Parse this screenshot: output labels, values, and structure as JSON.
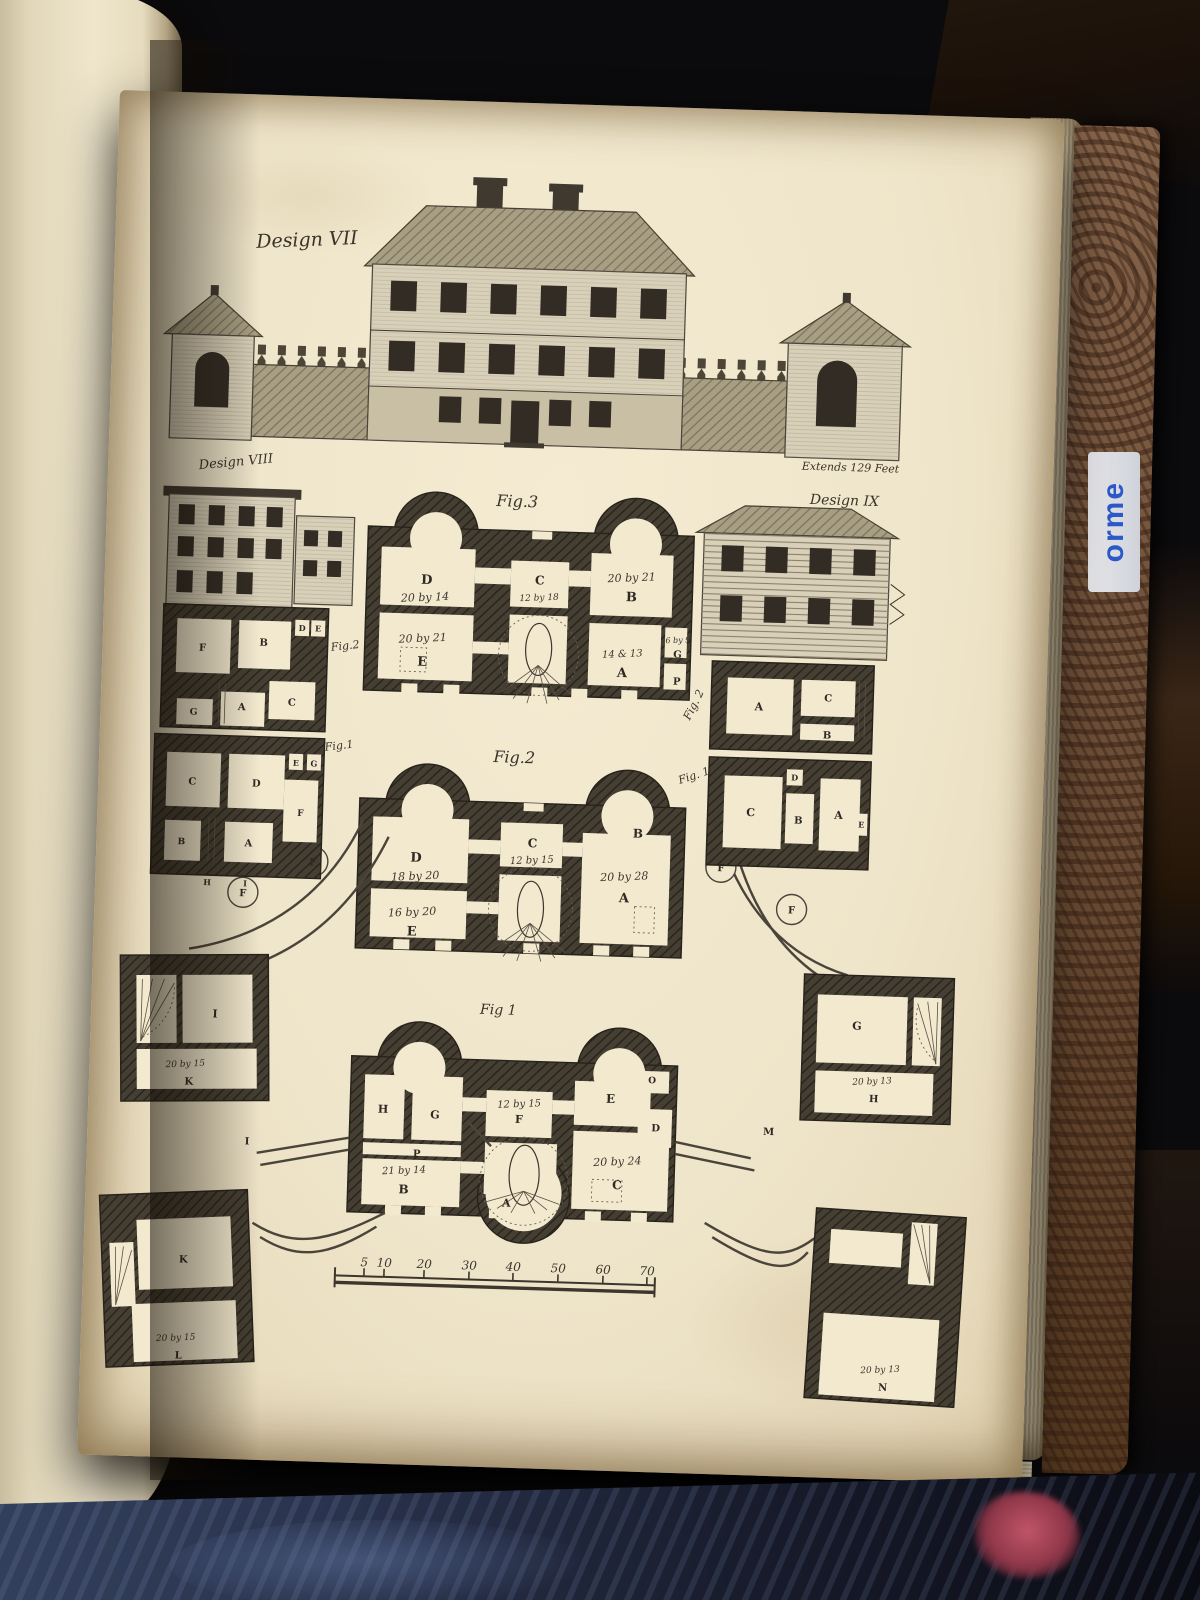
{
  "photo": {
    "spine_text": "orme"
  },
  "plate": {
    "captions": {
      "design7": "Design VII",
      "extends_note": "Extends 129 Feet",
      "design8": "Design VIII",
      "design9": "Design IX",
      "fig3": "Fig.3",
      "fig2_main": "Fig.2",
      "fig1_main": "Fig 1",
      "fig2_left": "Fig.2",
      "fig1_left": "Fig.1",
      "fig2_right": "Fig. 2",
      "fig1_right": "Fig. 1."
    },
    "labels": [
      {
        "t": "D",
        "x": 322,
        "y": 484,
        "s": 13,
        "k": "L"
      },
      {
        "t": "20 by 14",
        "x": 321,
        "y": 501,
        "s": 11,
        "k": "d"
      },
      {
        "t": "C",
        "x": 435,
        "y": 481,
        "s": 12,
        "k": "L"
      },
      {
        "t": "12 by 18",
        "x": 435,
        "y": 497,
        "s": 9,
        "k": "d"
      },
      {
        "t": "20 by 21",
        "x": 527,
        "y": 475,
        "s": 11,
        "k": "d"
      },
      {
        "t": "B",
        "x": 527,
        "y": 495,
        "s": 13,
        "k": "L"
      },
      {
        "t": "20 by 21",
        "x": 320,
        "y": 542,
        "s": 11,
        "k": "d"
      },
      {
        "t": "E",
        "x": 320,
        "y": 566,
        "s": 13,
        "k": "L"
      },
      {
        "t": "14 & 13",
        "x": 520,
        "y": 551,
        "s": 10,
        "k": "d"
      },
      {
        "t": "A",
        "x": 520,
        "y": 571,
        "s": 13,
        "k": "L"
      },
      {
        "t": "6 by 9",
        "x": 575,
        "y": 535,
        "s": 8,
        "k": "d"
      },
      {
        "t": "G",
        "x": 575,
        "y": 550,
        "s": 10,
        "k": "L"
      },
      {
        "t": "P",
        "x": 575,
        "y": 577,
        "s": 10,
        "k": "L"
      },
      {
        "t": "D",
        "x": 320,
        "y": 762,
        "s": 13,
        "k": "L"
      },
      {
        "t": "18 by 20",
        "x": 320,
        "y": 780,
        "s": 11,
        "k": "d"
      },
      {
        "t": "C",
        "x": 436,
        "y": 744,
        "s": 12,
        "k": "L"
      },
      {
        "t": "12 by 15",
        "x": 436,
        "y": 760,
        "s": 10,
        "k": "d"
      },
      {
        "t": "B",
        "x": 541,
        "y": 731,
        "s": 12,
        "k": "L"
      },
      {
        "t": "20 by 28",
        "x": 529,
        "y": 774,
        "s": 11,
        "k": "d"
      },
      {
        "t": "A",
        "x": 529,
        "y": 796,
        "s": 13,
        "k": "L"
      },
      {
        "t": "16 by 20",
        "x": 318,
        "y": 816,
        "s": 11,
        "k": "d"
      },
      {
        "t": "E",
        "x": 318,
        "y": 836,
        "s": 13,
        "k": "L"
      },
      {
        "t": "F",
        "x": 148,
        "y": 802,
        "s": 10,
        "k": "L"
      },
      {
        "t": "F",
        "x": 217,
        "y": 769,
        "s": 10,
        "k": "L"
      },
      {
        "t": "F",
        "x": 625,
        "y": 762,
        "s": 10,
        "k": "L"
      },
      {
        "t": "F",
        "x": 697,
        "y": 802,
        "s": 10,
        "k": "L"
      },
      {
        "t": "H",
        "x": 295,
        "y": 1014,
        "s": 11,
        "k": "L"
      },
      {
        "t": "G",
        "x": 347,
        "y": 1018,
        "s": 11,
        "k": "L"
      },
      {
        "t": "12 by 15",
        "x": 431,
        "y": 1004,
        "s": 10,
        "k": "d"
      },
      {
        "t": "F",
        "x": 431,
        "y": 1020,
        "s": 11,
        "k": "L"
      },
      {
        "t": "E",
        "x": 522,
        "y": 997,
        "s": 12,
        "k": "L"
      },
      {
        "t": "O",
        "x": 563,
        "y": 976,
        "s": 9,
        "k": "L"
      },
      {
        "t": "D",
        "x": 568,
        "y": 1024,
        "s": 10,
        "k": "L"
      },
      {
        "t": "P",
        "x": 330,
        "y": 1057,
        "s": 10,
        "k": "L"
      },
      {
        "t": "21 by 14",
        "x": 318,
        "y": 1074,
        "s": 10,
        "k": "d"
      },
      {
        "t": "B",
        "x": 318,
        "y": 1094,
        "s": 12,
        "k": "L"
      },
      {
        "t": "20 by 24",
        "x": 531,
        "y": 1059,
        "s": 11,
        "k": "d"
      },
      {
        "t": "C",
        "x": 531,
        "y": 1083,
        "s": 12,
        "k": "L"
      },
      {
        "t": "A",
        "x": 421,
        "y": 1104,
        "s": 11,
        "k": "L"
      },
      {
        "t": "F",
        "x": 100,
        "y": 558,
        "s": 10,
        "k": "L"
      },
      {
        "t": "B",
        "x": 161,
        "y": 551,
        "s": 10,
        "k": "L"
      },
      {
        "t": "D",
        "x": 199,
        "y": 535,
        "s": 8,
        "k": "L"
      },
      {
        "t": "E",
        "x": 215,
        "y": 535,
        "s": 8,
        "k": "L"
      },
      {
        "t": "C",
        "x": 191,
        "y": 610,
        "s": 10,
        "k": "L"
      },
      {
        "t": "A",
        "x": 141,
        "y": 616,
        "s": 10,
        "k": "L"
      },
      {
        "t": "G",
        "x": 93,
        "y": 622,
        "s": 9,
        "k": "L"
      },
      {
        "t": "C",
        "x": 94,
        "y": 692,
        "s": 10,
        "k": "L"
      },
      {
        "t": "D",
        "x": 158,
        "y": 692,
        "s": 10,
        "k": "L"
      },
      {
        "t": "E",
        "x": 197,
        "y": 670,
        "s": 8,
        "k": "L"
      },
      {
        "t": "G",
        "x": 215,
        "y": 670,
        "s": 8,
        "k": "L"
      },
      {
        "t": "F",
        "x": 203,
        "y": 720,
        "s": 9,
        "k": "L"
      },
      {
        "t": "B",
        "x": 85,
        "y": 752,
        "s": 9,
        "k": "L"
      },
      {
        "t": "A",
        "x": 152,
        "y": 752,
        "s": 10,
        "k": "L"
      },
      {
        "t": "H",
        "x": 112,
        "y": 792,
        "s": 8,
        "k": "L"
      },
      {
        "t": "I",
        "x": 150,
        "y": 792,
        "s": 8,
        "k": "L"
      },
      {
        "t": "A",
        "x": 658,
        "y": 600,
        "s": 11,
        "k": "L"
      },
      {
        "t": "C",
        "x": 727,
        "y": 589,
        "s": 10,
        "k": "L"
      },
      {
        "t": "B",
        "x": 727,
        "y": 626,
        "s": 10,
        "k": "L"
      },
      {
        "t": "C",
        "x": 653,
        "y": 706,
        "s": 11,
        "k": "L"
      },
      {
        "t": "D",
        "x": 696,
        "y": 669,
        "s": 8,
        "k": "L"
      },
      {
        "t": "B",
        "x": 701,
        "y": 712,
        "s": 10,
        "k": "L"
      },
      {
        "t": "A",
        "x": 741,
        "y": 706,
        "s": 11,
        "k": "L"
      },
      {
        "t": "E",
        "x": 764,
        "y": 714,
        "s": 8,
        "k": "L"
      },
      {
        "t": "I",
        "x": 124,
        "y": 924,
        "s": 11,
        "k": "L"
      },
      {
        "t": "20 by 15",
        "x": 96,
        "y": 974,
        "s": 9,
        "k": "d"
      },
      {
        "t": "K",
        "x": 100,
        "y": 992,
        "s": 10,
        "k": "L"
      },
      {
        "t": "K",
        "x": 100,
        "y": 1170,
        "s": 10,
        "k": "L"
      },
      {
        "t": "20 by 15",
        "x": 95,
        "y": 1248,
        "s": 9,
        "k": "d"
      },
      {
        "t": "L",
        "x": 98,
        "y": 1266,
        "s": 10,
        "k": "L"
      },
      {
        "t": "G",
        "x": 766,
        "y": 916,
        "s": 11,
        "k": "L"
      },
      {
        "t": "20 by 13",
        "x": 783,
        "y": 970,
        "s": 9,
        "k": "d"
      },
      {
        "t": "H",
        "x": 785,
        "y": 988,
        "s": 10,
        "k": "L"
      },
      {
        "t": "20 by 13",
        "x": 800,
        "y": 1258,
        "s": 9,
        "k": "d"
      },
      {
        "t": "N",
        "x": 803,
        "y": 1276,
        "s": 10,
        "k": "L"
      },
      {
        "t": "I",
        "x": 160,
        "y": 1050,
        "s": 10,
        "k": "L"
      },
      {
        "t": "M",
        "x": 681,
        "y": 1024,
        "s": 10,
        "k": "L"
      }
    ],
    "scale": {
      "ticks": [
        "5",
        "10",
        "20",
        "30",
        "40",
        "50",
        "60",
        "70"
      ],
      "tick_x": [
        281,
        301,
        341,
        386,
        430,
        475,
        520,
        564
      ],
      "num_y": 1168,
      "bar_y1": 1178,
      "bar_y2": 1185,
      "bar_x1": 252,
      "bar_x2": 572
    }
  }
}
